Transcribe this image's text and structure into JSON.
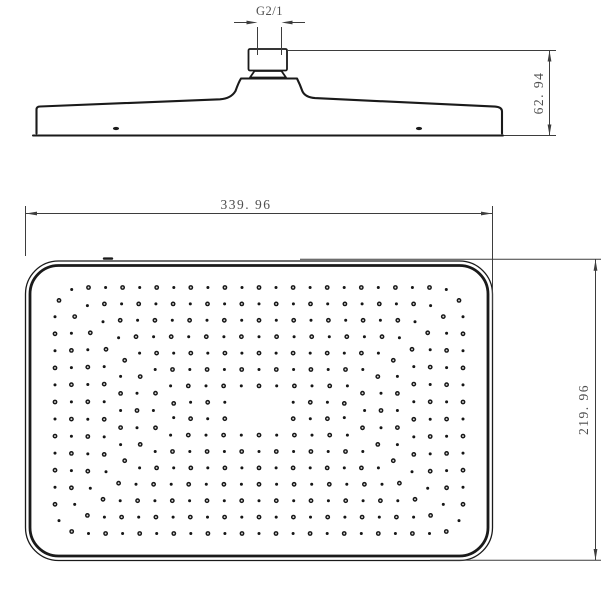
{
  "drawing": {
    "background": "#ffffff",
    "line_color": "#1a1a1a",
    "dim_color": "#3d3d3d",
    "text_color": "#4f4f4f",
    "side_view": {
      "thread_label": "G2/1",
      "height_dim": "62. 94"
    },
    "face_view": {
      "width_dim": "339. 96",
      "height_dim": "219. 96",
      "nozzle_pattern": {
        "cx": 259,
        "cy": 410.5,
        "half_width": 204,
        "half_height": 123,
        "ring_inset": 16.4,
        "rings": 8,
        "corner_radius_start": 27,
        "corner_radius_step": 2,
        "corner_radius_min": 8,
        "dot_spacing": 17.4,
        "big_dot_radius": 2.4,
        "big_dot_hole_radius": 0.95,
        "small_dot_radius": 1.5,
        "void_half_width": 26,
        "void_half_height": 13,
        "dot_color": "#161616",
        "hole_color": "#d6d6d6"
      }
    }
  }
}
